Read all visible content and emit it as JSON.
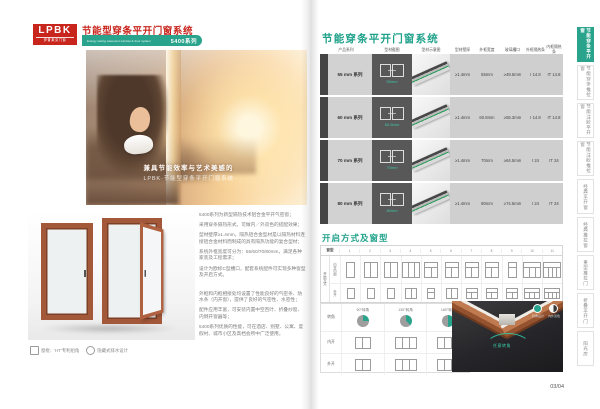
{
  "brand": {
    "logo_text": "LPBK",
    "logo_sub": "伊普莱克门窗",
    "red": "#c8251c",
    "teal": "#2aa38c"
  },
  "left_page": {
    "header": {
      "title": "节能型穿条平开门窗系统",
      "subtitle_en": "Energy saving casement window & door system",
      "series_tag": "5400系列"
    },
    "hero": {
      "caption_line1": "兼具节能效率与艺术美感的",
      "caption_line2": "LPBK·节能型穿条平开门窗系统···"
    },
    "product_caption": [
      {
        "icon": "corner-joint-icon",
        "label": "窗框：'HT'专利组角"
      },
      {
        "icon": "drain-icon",
        "label": "隐藏式排水设计"
      }
    ],
    "body_paragraphs": [
      "5400系列为新型隔热技术铝合金平开气密窗；",
      "采用穿条隔热形式，可做内／外双色的搭配效果；",
      "型材壁厚≥1.4mm，隔热铝合金型材是以隔热材料连接铝合金材料而制成的具有隔热功能的复合型材；",
      "系统外框宽度可分为：55/60/70/80mm，满足各种家装及工程需求；",
      "设计为欧标C型槽口，配套系统配件可实现多种窗型及开启方式。",
      "外框和内框相接处均设置了性能良好的气密条、防水条（内开窗），提供了良好的气密性、水密性；",
      "配件应用丰富，可安装内置中空百叶、折叠纱窗、内倒开窗器等；",
      "5400系列优质的性能，可在酒店、别墅、公寓、度假村、城市小区及高档会所中广泛使用。"
    ]
  },
  "right_page": {
    "section1_title": "节能穿条平开门窗系统",
    "table": {
      "headers": [
        "产品系列",
        "型材截图",
        "型材示意图",
        "型材壁厚",
        "外框宽度",
        "玻璃槽口",
        "外框隔热条",
        "内框隔热条"
      ],
      "rows": [
        {
          "series": "55 mm 系列",
          "dim_label": "55mm",
          "values": [
            "≥1.4mm",
            "55mm",
            "≥49.5mm",
            "I 14.8",
            "IT 14.8"
          ]
        },
        {
          "series": "60 mm 系列",
          "dim_label": "60.8mm",
          "values": [
            "≥1.4mm",
            "60.8mm",
            "≥55.3mm",
            "I 14.8",
            "IT 14.8"
          ]
        },
        {
          "series": "70 mm 系列",
          "dim_label": "70mm",
          "values": [
            "≥1.4mm",
            "70mm",
            "≥64.5mm",
            "I 24",
            "IT 24"
          ]
        },
        {
          "series": "80 mm 系列",
          "dim_label": "80mm",
          "values": [
            "≥1.4mm",
            "80mm",
            "≥74.5mm",
            "I 24",
            "IT 24"
          ]
        }
      ]
    },
    "section2_title": "开启方式及窗型",
    "window_grid": {
      "corner_header": "窗型",
      "row_group_label": "开启方式",
      "row_labels": [
        "内开内倒",
        "外开"
      ],
      "columns": [
        {
          "code": "1",
          "inner": {
            "panes": 1,
            "transom": false
          },
          "outer": {
            "panes": 1,
            "transom": false
          }
        },
        {
          "code": "2",
          "inner": {
            "panes": 2,
            "transom": false
          },
          "outer": {
            "panes": 1,
            "transom": false
          }
        },
        {
          "code": "3",
          "inner": {
            "panes": 2,
            "transom": false
          },
          "outer": {
            "panes": 1,
            "transom": false
          }
        },
        {
          "code": "4",
          "inner": {
            "panes": 3,
            "transom": false
          },
          "outer": {
            "panes": 2,
            "transom": false
          }
        },
        {
          "code": "5",
          "inner": {
            "panes": 2,
            "transom": true
          },
          "outer": {
            "panes": 1,
            "transom": true
          }
        },
        {
          "code": "6",
          "inner": {
            "panes": 2,
            "transom": true
          },
          "outer": {
            "panes": 2,
            "transom": false
          }
        },
        {
          "code": "7",
          "inner": {
            "panes": 2,
            "transom": true
          },
          "outer": {
            "panes": 2,
            "transom": true
          }
        },
        {
          "code": "8",
          "inner": {
            "panes": 2,
            "transom": true
          },
          "outer": {
            "panes": 2,
            "transom": true
          }
        },
        {
          "code": "9",
          "inner": {
            "panes": 1,
            "transom": true
          },
          "outer": {
            "panes": 2,
            "transom": true
          }
        },
        {
          "code": "10",
          "inner": {
            "panes": 3,
            "transom": true
          },
          "outer": {
            "panes": 3,
            "transom": true
          }
        },
        {
          "code": "11",
          "inner": {
            "panes": 4,
            "transom": true
          },
          "outer": {
            "panes": 4,
            "transom": true
          }
        }
      ]
    },
    "corner_section": {
      "row_labels": [
        "转角",
        "内开",
        "外开"
      ],
      "pies": [
        {
          "label": "90°转角",
          "deg": 90
        },
        {
          "label": "135°转角",
          "deg": 135
        },
        {
          "label": "180°转角",
          "deg": 180
        }
      ],
      "inner_diagrams": [
        2,
        3,
        3
      ],
      "outer_diagrams": [
        2,
        3,
        3
      ]
    },
    "corner_photo": {
      "badges": [
        {
          "icon": "corner-angle-icon",
          "label": "转角设计"
        },
        {
          "icon": "dual-color-icon",
          "label": "内外双色"
        }
      ],
      "arrow_label": "任意转角"
    },
    "page_number": "03/04"
  },
  "sidebar": {
    "tabs": [
      {
        "label": "节能穿条平开窗",
        "active": true
      },
      {
        "label": "节能穿条推拉窗",
        "active": false
      },
      {
        "label": "节能注胶平开窗",
        "active": false
      },
      {
        "label": "节能注胶推拉窗",
        "active": false
      },
      {
        "label": "经典平开窗",
        "active": false
      },
      {
        "label": "经典推拉窗",
        "active": false
      },
      {
        "label": "重型推拉门",
        "active": false
      },
      {
        "label": "折叠平开门",
        "active": false
      },
      {
        "label": "阳光房",
        "active": false
      }
    ]
  }
}
